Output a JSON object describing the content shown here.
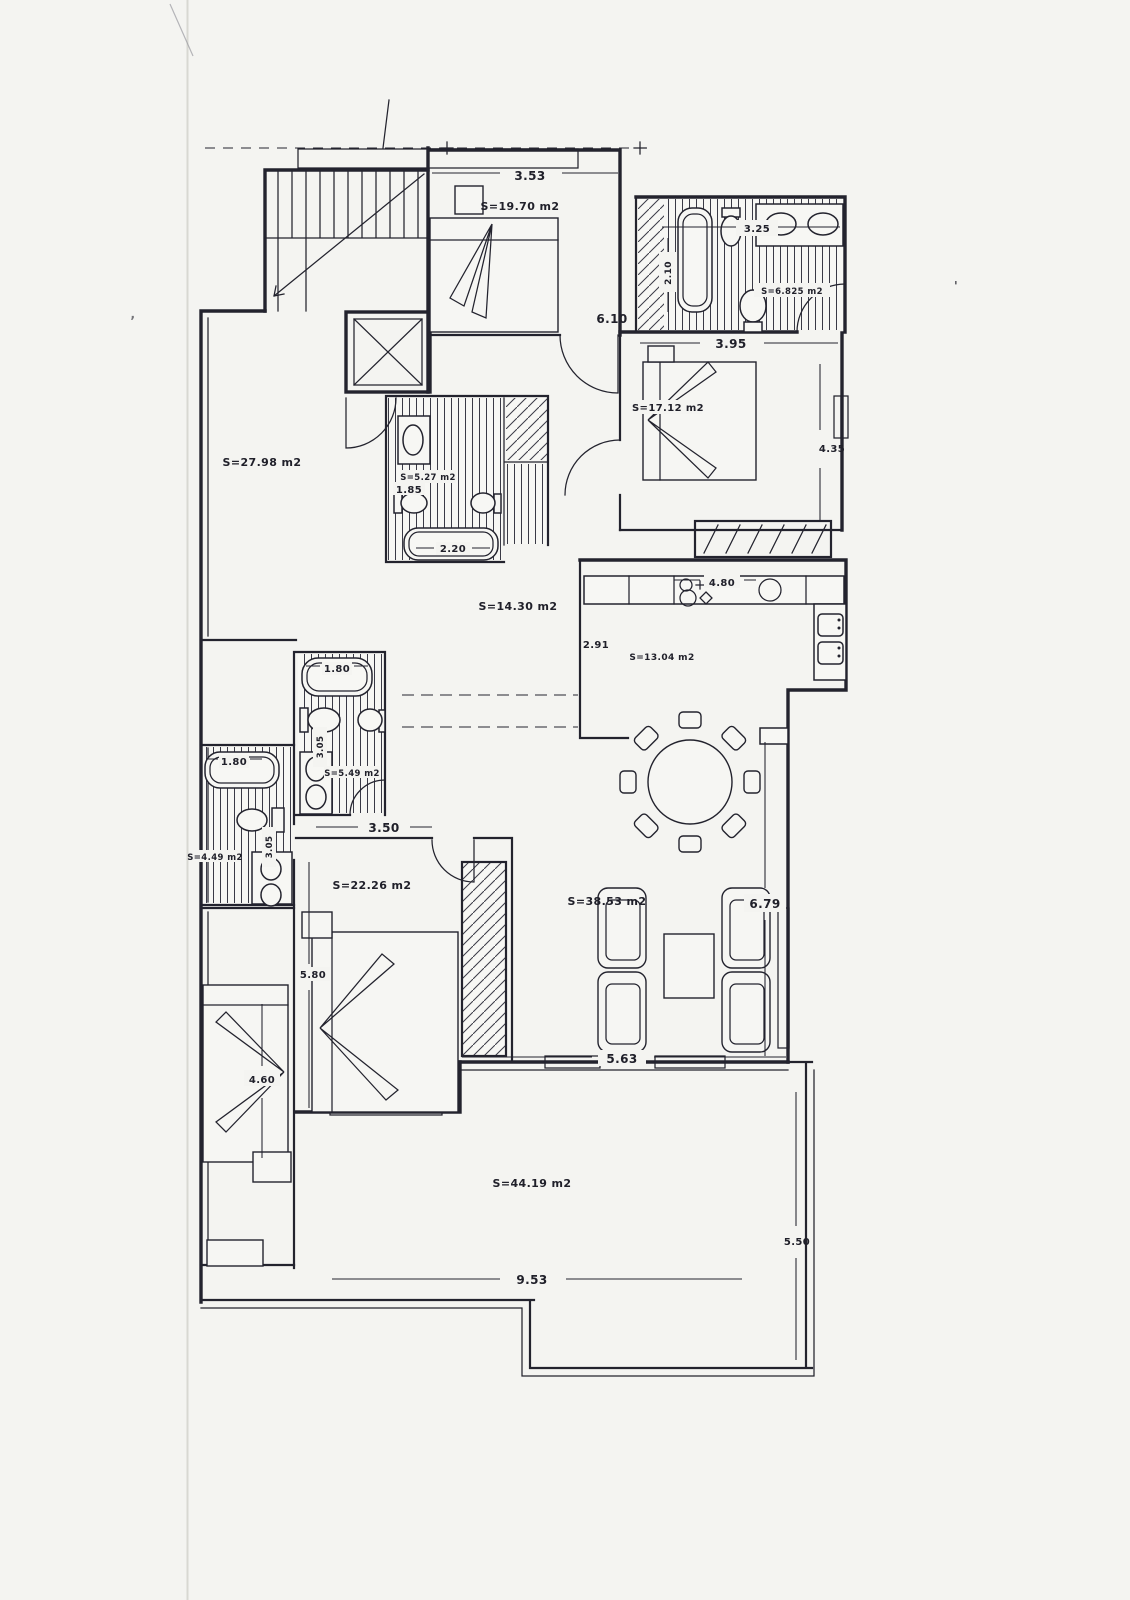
{
  "document": {
    "kind": "Scanned apartment floor plan",
    "ink_color": "#23232e",
    "paper_color": "#f3f3f0"
  },
  "labels": {
    "dim_top_bedroom_width": "3.53",
    "area_top_bedroom": "S=19.70 m2",
    "dim_top_bath_width": "3.25",
    "dim_top_bath_depth": "2.10",
    "area_top_bath": "S=6.825 m2",
    "dim_hall_top": "6.10",
    "dim_right_bedroom_width": "3.95",
    "area_right_bedroom": "S=17.12 m2",
    "dim_right_bedroom_height": "4.35",
    "area_left_room": "S=27.98 m2",
    "area_mid_bath": "S=5.27 m2",
    "dim_mid_bath_width": "1.85",
    "dim_mid_bath_tub": "2.20",
    "area_hall": "S=14.30 m2",
    "dim_kitchen_width": "4.80",
    "dim_kitchen_depth": "2.91",
    "area_kitchen": "S=13.04 m2",
    "dim_bath2_tub": "1.80",
    "dim_bath2_depth": "3.05",
    "area_bath2": "S=5.49 m2",
    "dim_bath3_tub": "1.80",
    "dim_bath3_depth": "3.05",
    "area_bath3": "S=4.49 m2",
    "dim_bedroom2_width": "3.50",
    "area_bedroom2": "S=22.26 m2",
    "dim_bedroom2_height": "5.80",
    "area_living": "S=38.53 m2",
    "dim_living_height": "6.79",
    "dim_living_width": "5.63",
    "dim_left_bedroom_height": "4.60",
    "area_terrace": "S=44.19 m2",
    "dim_terrace_width": "9.53",
    "dim_terrace_height": "5.50",
    "speck_right": "'",
    "speck_left": ","
  }
}
